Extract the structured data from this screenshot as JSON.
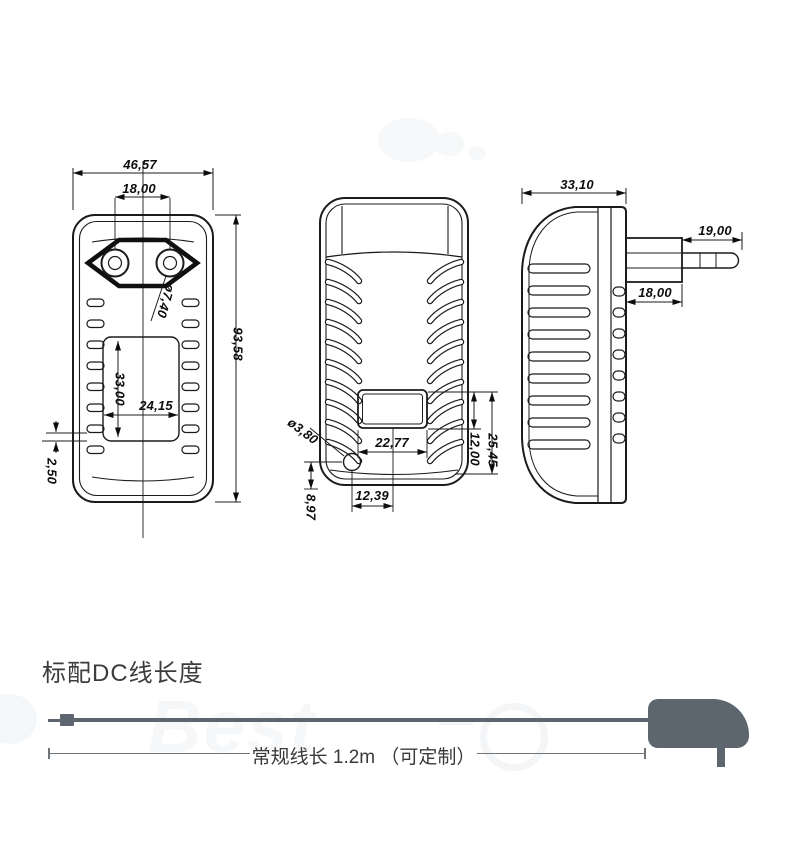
{
  "colors": {
    "drawing_line": "#1b1b1b",
    "cable": "#5d656e",
    "title_text": "#3c3c3c"
  },
  "watermark": {
    "text": "Best"
  },
  "drawing": {
    "front_view": {
      "width": "46,57",
      "pin_spacing": "18,00",
      "pin_diameter": "ø7,40",
      "height": "93,58",
      "window_height": "33,00",
      "window_width": "24,15",
      "rib_gap": "2,50"
    },
    "back_view": {
      "label_width": "22,77",
      "hole_diameter": "ø3,80",
      "hole_offset_x": "12,39",
      "hole_offset_y": "8,97",
      "label_height": "12,00",
      "label_offset": "25,45"
    },
    "side_view": {
      "depth": "33,10",
      "pin_length": "19,00",
      "plug_head_depth": "18,00"
    }
  },
  "cable_section": {
    "title": "标配DC线长度",
    "length_label": "常规线长 1.2m （可定制）"
  }
}
